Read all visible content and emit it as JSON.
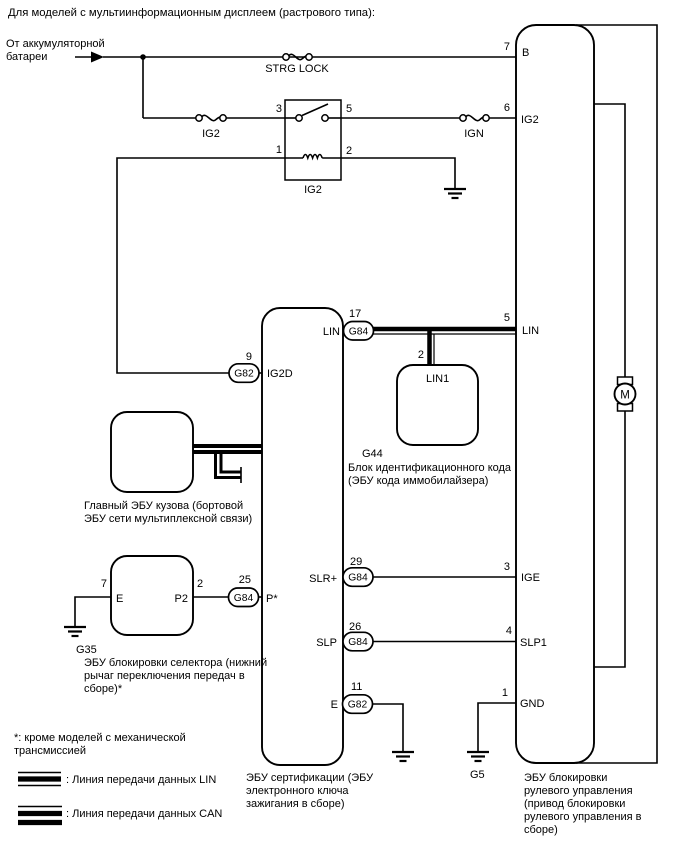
{
  "title": "Для моделей с мультиинформационным дисплеем (растрового типа):",
  "source": {
    "line1": "От аккумуляторной",
    "line2": "батареи"
  },
  "fuses": {
    "strg_lock": "STRG LOCK",
    "ig2": "IG2",
    "ign": "IGN"
  },
  "relay": {
    "label": "IG2",
    "pin_contact_in": "3",
    "pin_contact_out": "5",
    "pin_coil_left": "1",
    "pin_coil_right": "2"
  },
  "cert_ecu": {
    "label_line1": "ЭБУ сертификации (ЭБУ",
    "label_line2": "электронного ключа",
    "label_line3": "зажигания в сборе)",
    "pin_lin": {
      "num": "17",
      "conn": "G84",
      "name": "LIN"
    },
    "pin_ig2d": {
      "num": "9",
      "conn": "G82",
      "name": "IG2D"
    },
    "pin_slr": {
      "num": "29",
      "conn": "G84",
      "name": "SLR+"
    },
    "pin_slp": {
      "num": "26",
      "conn": "G84",
      "name": "SLP"
    },
    "pin_p": {
      "num": "25",
      "conn": "G84",
      "name": "P*"
    },
    "pin_e": {
      "num": "11",
      "conn": "G82",
      "name": "E"
    }
  },
  "steering_ecu": {
    "label_line1": "ЭБУ блокировки",
    "label_line2": "рулевого управления",
    "label_line3": "(привод блокировки",
    "label_line4": "рулевого управления в",
    "label_line5": "сборе)",
    "motor": "M",
    "pin_b": {
      "num": "7",
      "name": "B"
    },
    "pin_ig2": {
      "num": "6",
      "name": "IG2"
    },
    "pin_lin": {
      "num": "5",
      "name": "LIN"
    },
    "pin_ige": {
      "num": "3",
      "name": "IGE"
    },
    "pin_slp1": {
      "num": "4",
      "name": "SLP1"
    },
    "pin_gnd": {
      "num": "1",
      "name": "GND"
    }
  },
  "id_code_ecu": {
    "code": "G44",
    "label_line1": "Блок идентификационного кода",
    "label_line2": "(ЭБУ кода иммобилайзера)",
    "pin_lin1": {
      "num": "2",
      "name": "LIN1"
    }
  },
  "body_ecu": {
    "label_line1": "Главный ЭБУ кузова (бортовой",
    "label_line2": "ЭБУ сети мультиплексной связи)"
  },
  "selector_ecu": {
    "code": "G35",
    "label_line1": "ЭБУ блокировки селектора (нижний",
    "label_line2": "рычаг переключения передач в",
    "label_line3": "сборе)*",
    "pin_e": {
      "num": "7",
      "name": "E"
    },
    "pin_p2": {
      "num": "2",
      "name": "P2"
    }
  },
  "grounds": {
    "g5": "G5"
  },
  "footnote": {
    "line1": "*: кроме моделей с механической",
    "line2": "трансмиссией"
  },
  "legend": {
    "lin": ": Линия передачи данных LIN",
    "can": ": Линия передачи данных CAN"
  },
  "colors": {
    "line": "#000000",
    "background": "#ffffff"
  }
}
